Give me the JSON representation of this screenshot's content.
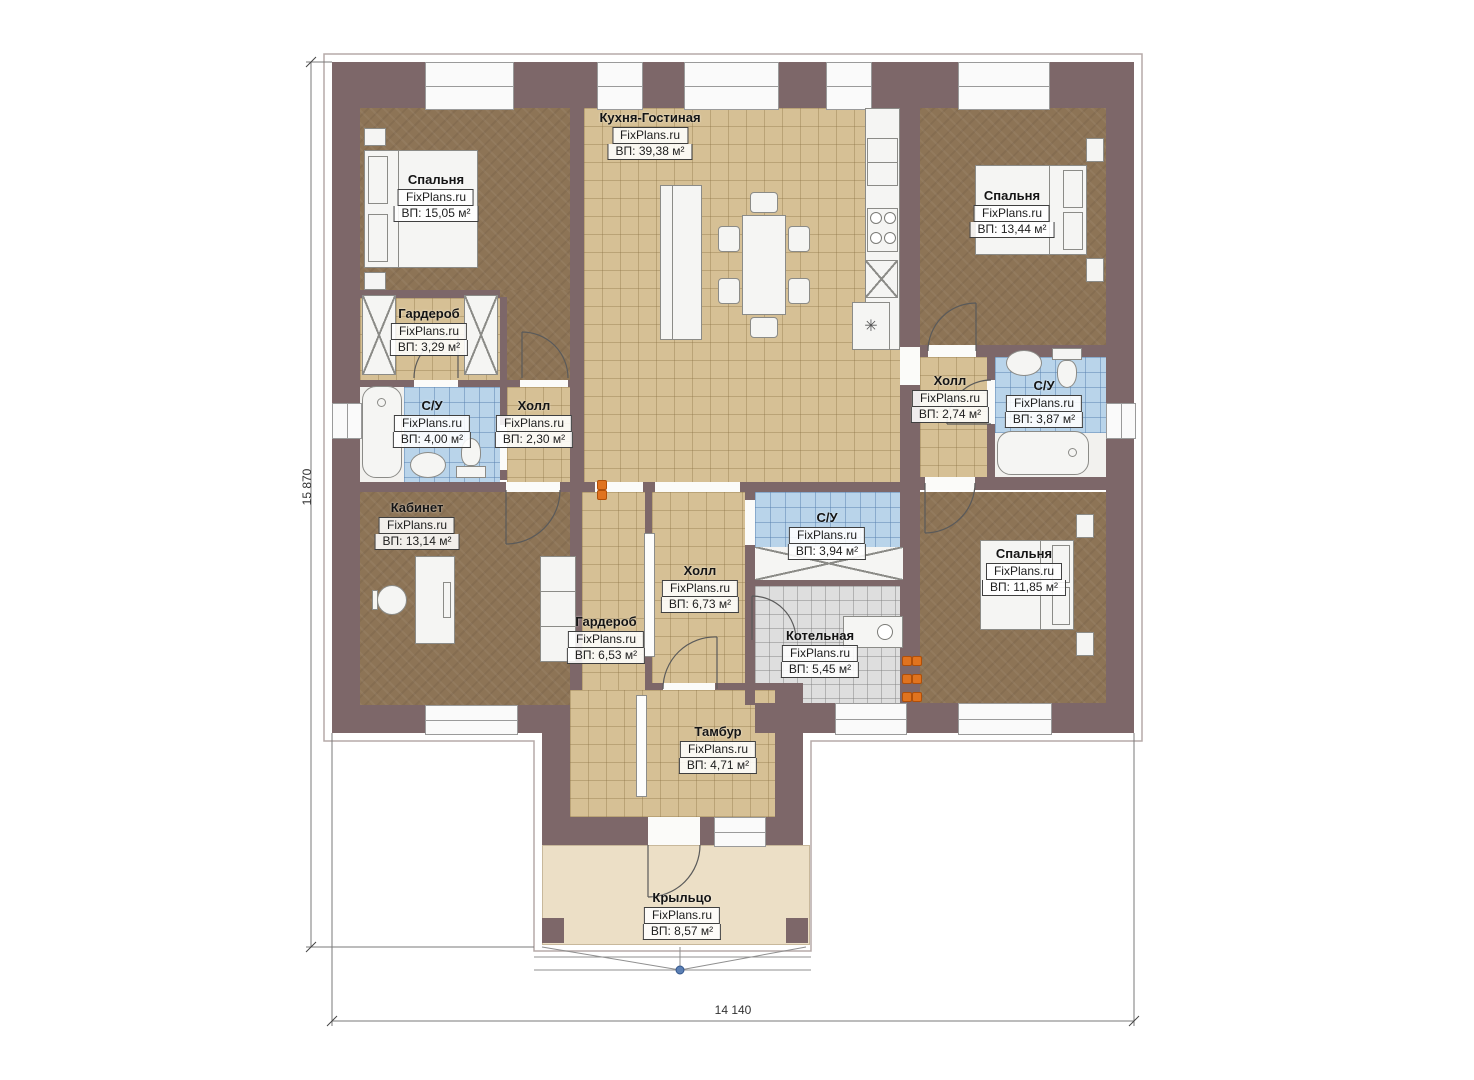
{
  "plan": {
    "watermark": "FixPlans.ru",
    "dimensions": {
      "height": "15 870",
      "width": "14 140"
    },
    "rooms": [
      {
        "id": "bedroom-top-left",
        "name": "Спальня",
        "area": "ВП: 15,05 м²"
      },
      {
        "id": "kitchen-living",
        "name": "Кухня-Гостиная",
        "area": "ВП: 39,38 м²"
      },
      {
        "id": "bedroom-top-right",
        "name": "Спальня",
        "area": "ВП: 13,44 м²"
      },
      {
        "id": "wardrobe-top",
        "name": "Гардероб",
        "area": "ВП: 3,29 м²"
      },
      {
        "id": "bathroom-left",
        "name": "С/У",
        "area": "ВП: 4,00 м²"
      },
      {
        "id": "hall-left",
        "name": "Холл",
        "area": "ВП: 2,30 м²"
      },
      {
        "id": "hall-right",
        "name": "Холл",
        "area": "ВП: 2,74 м²"
      },
      {
        "id": "bathroom-right",
        "name": "С/У",
        "area": "ВП: 3,87 м²"
      },
      {
        "id": "office",
        "name": "Кабинет",
        "area": "ВП: 13,14 м²"
      },
      {
        "id": "wardrobe-bottom",
        "name": "Гардероб",
        "area": "ВП: 6,53 м²"
      },
      {
        "id": "hall-center",
        "name": "Холл",
        "area": "ВП: 6,73 м²"
      },
      {
        "id": "bathroom-center",
        "name": "С/У",
        "area": "ВП: 3,94 м²"
      },
      {
        "id": "boiler-room",
        "name": "Котельная",
        "area": "ВП: 5,45 м²"
      },
      {
        "id": "bedroom-bottom-right",
        "name": "Спальня",
        "area": "ВП: 11,85 м²"
      },
      {
        "id": "vestibule",
        "name": "Тамбур",
        "area": "ВП: 4,71 м²"
      },
      {
        "id": "porch",
        "name": "Крыльцо",
        "area": "ВП: 8,57 м²"
      }
    ]
  }
}
